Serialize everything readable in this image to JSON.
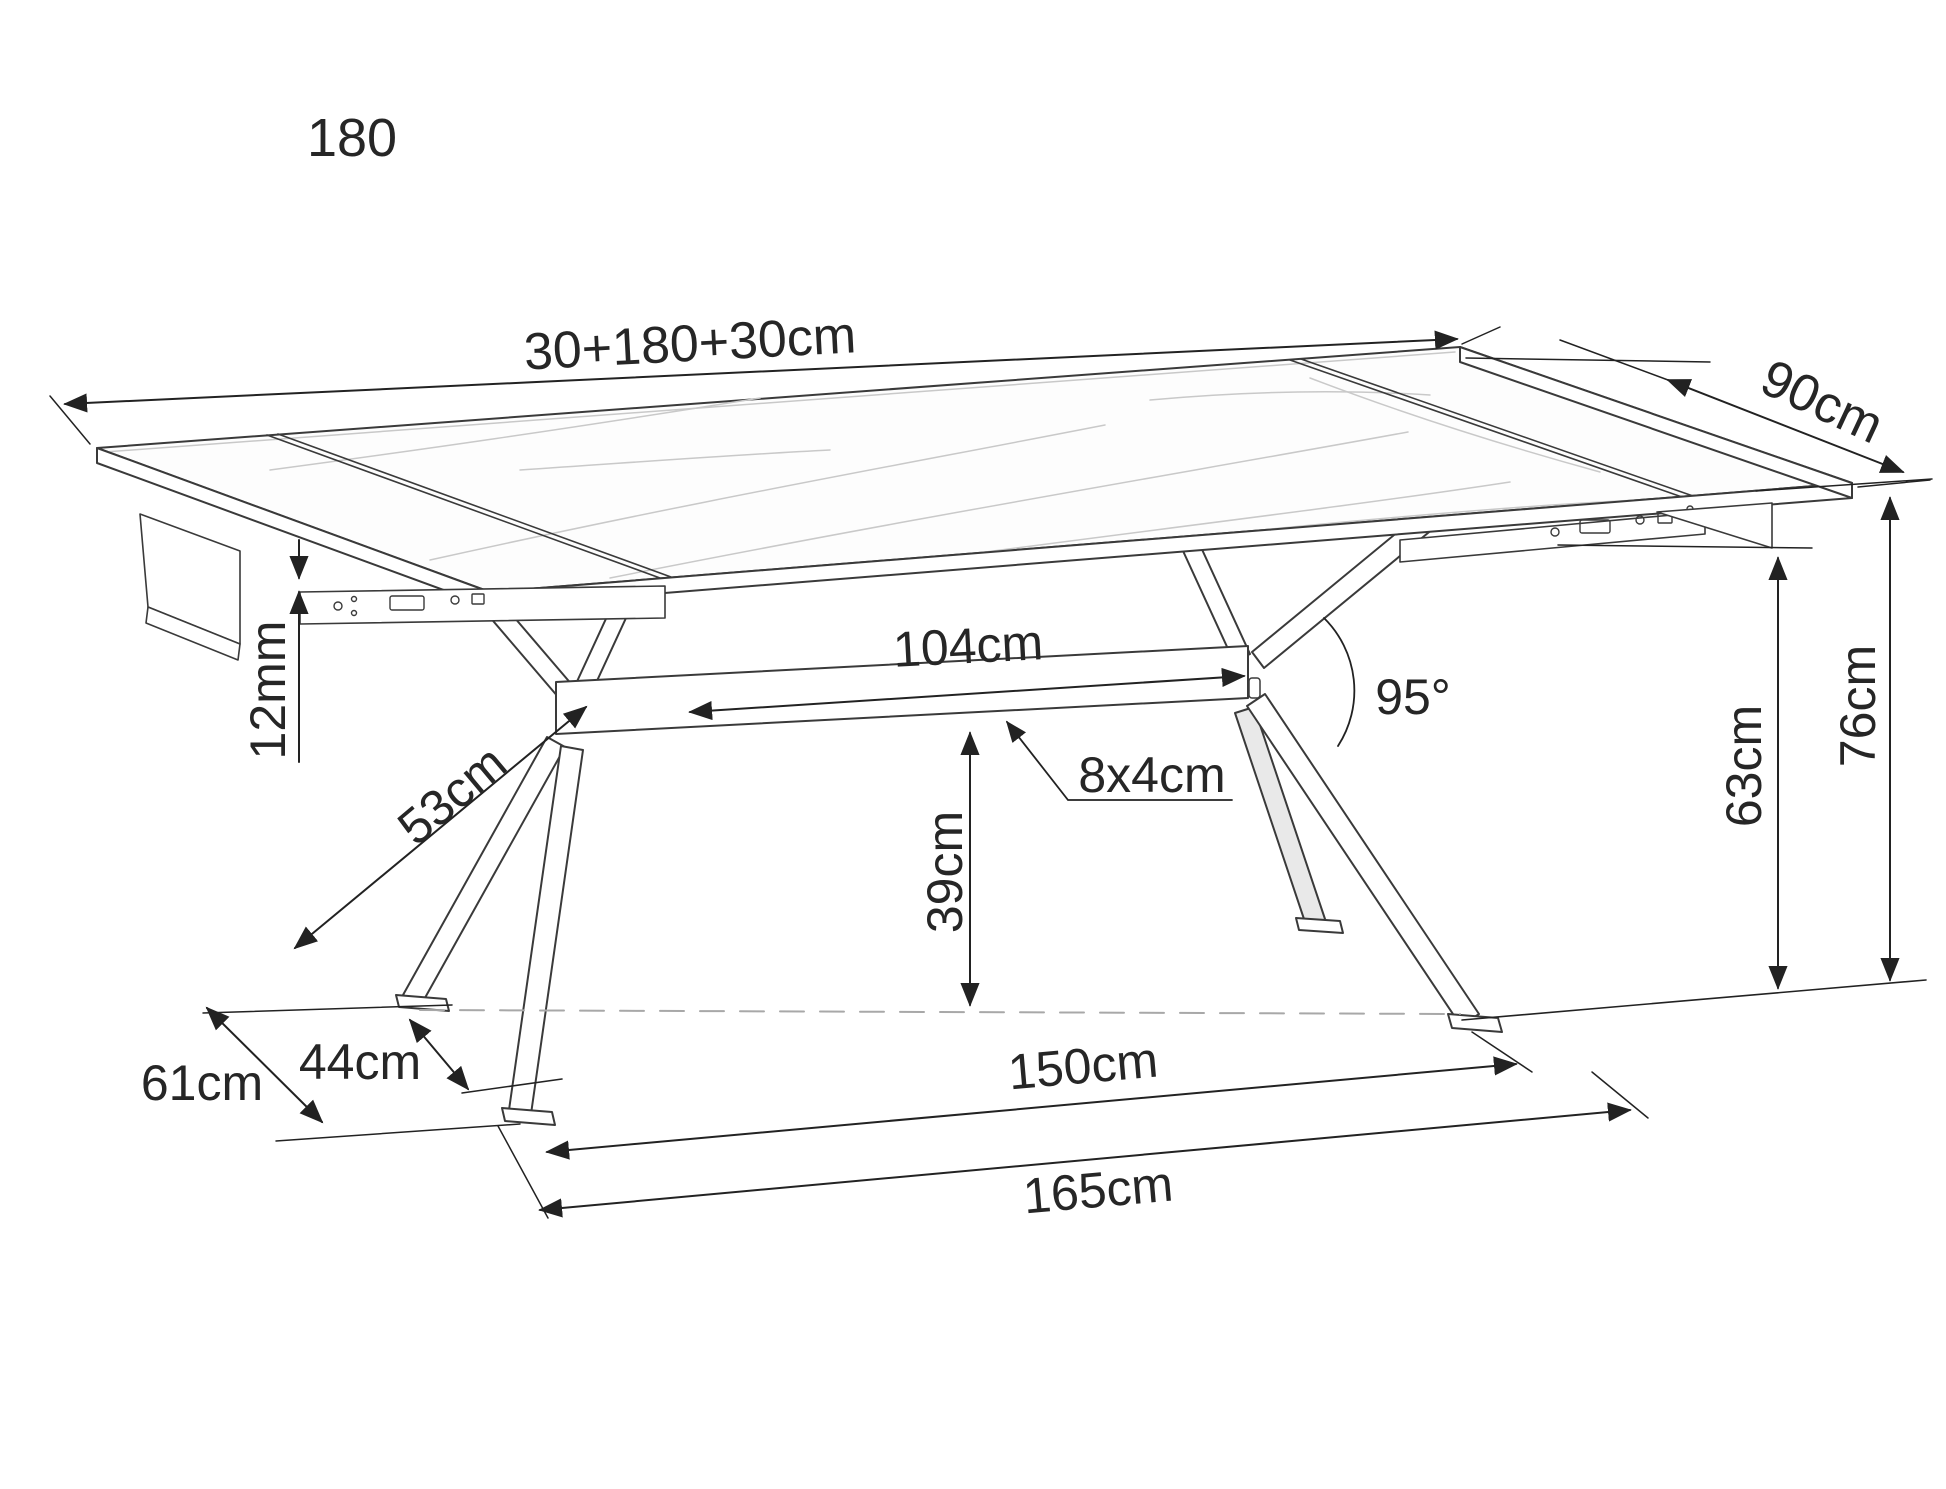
{
  "diagram": {
    "caption": "180",
    "dimensions": {
      "length_extended": "30+180+30cm",
      "depth": "90cm",
      "top_thickness": "12mm",
      "beam_length": "104cm",
      "leg_angle": "95°",
      "beam_section": "8x4cm",
      "leg_length": "53cm",
      "beam_height": "39cm",
      "underframe_height": "63cm",
      "table_height": "76cm",
      "base_depth_outer": "61cm",
      "base_depth_inner": "44cm",
      "feet_span": "150cm",
      "base_length": "165cm"
    },
    "colors": {
      "outline": "#3a3a3a",
      "dimension": "#222222",
      "vein": "#c9c9c9",
      "ground_dash": "#a8a8a8",
      "background": "#ffffff"
    }
  }
}
